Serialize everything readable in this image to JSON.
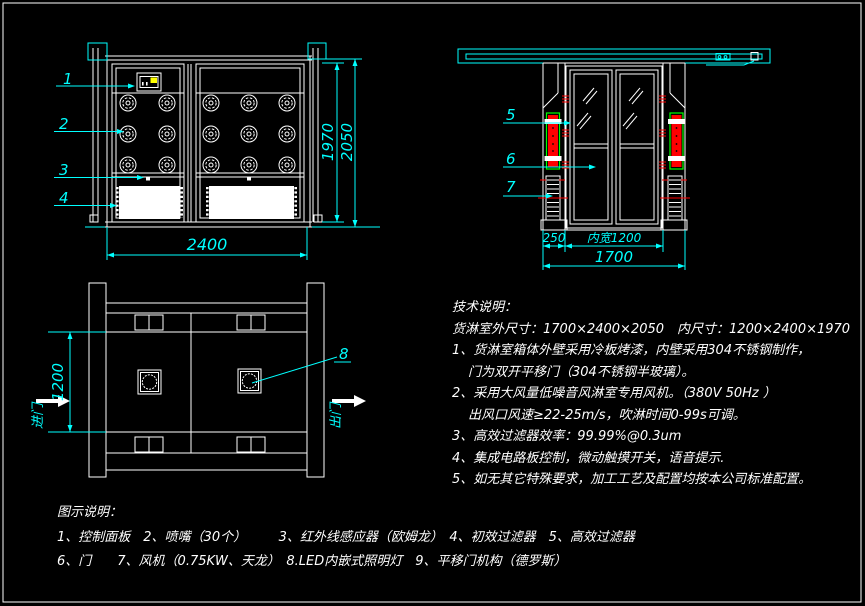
{
  "colors": {
    "background": "#000000",
    "lines": "#ffffff",
    "dimensions": "#00ffff",
    "hepa_filter_fill": "#ff0000",
    "hepa_filter_border": "#00ff00",
    "indicator": "#ffff00",
    "break_marks": "#ff0000"
  },
  "front_view": {
    "callout_1": "1",
    "callout_2": "2",
    "callout_3": "3",
    "callout_4": "4",
    "dim_width": "2400",
    "dim_inner_height": "1970",
    "dim_outer_height": "2050"
  },
  "side_view": {
    "callout_5": "5",
    "callout_6": "6",
    "callout_7": "7",
    "dim_left_section": "250",
    "dim_inner_width": "内宽1200",
    "dim_total": "1700"
  },
  "plan_view": {
    "callout_8": "8",
    "dim_inner_depth": "1200",
    "entry_label": "进门",
    "exit_label": "出门"
  },
  "tech_notes": {
    "title": "技术说明：",
    "lines": [
      "货淋室外尺寸：1700×2400×2050　内尺寸：1200×2400×1970",
      "1、货淋室箱体外壁采用冷板烤漆，内壁采用304不锈钢制作，",
      "门为双开平移门（304不锈钢半玻璃）。",
      "2、采用大风量低噪音风淋室专用风机。（380V 50Hz ）",
      "出风口风速≥22-25m/s，吹淋时间0-99s可调。",
      "3、高效过滤器效率：99.99%@0.3um",
      "4、集成电路板控制，微动触摸开关，语音提示.",
      "5、如无其它特殊要求，加工工艺及配置均按本公司标准配置。"
    ]
  },
  "legend": {
    "title": "图示说明：",
    "lines": [
      "1、控制面板　2、喷嘴（30个）　　　3、红外线感应器（欧姆龙）　4、初效过滤器　5、高效过滤器",
      "6、门　　7、风机（0.75KW、天龙）　8.LED内嵌式照明灯　9、平移门机构（德罗斯）"
    ]
  }
}
